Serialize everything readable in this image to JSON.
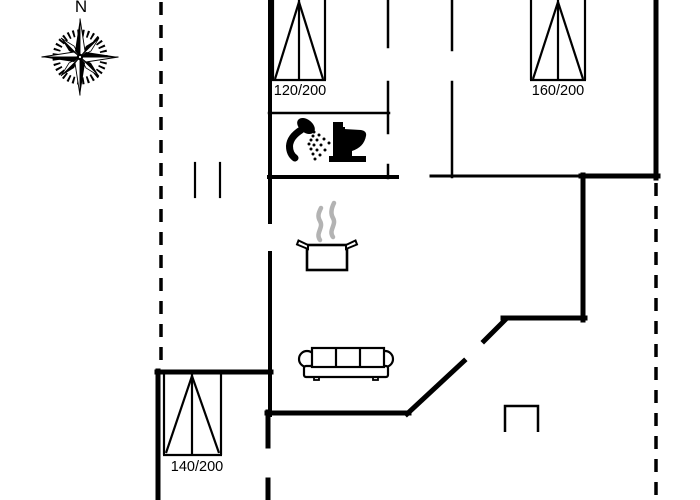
{
  "compass": {
    "north_label": "N"
  },
  "beds": [
    {
      "label": "120/200",
      "position": "top-left-bedroom"
    },
    {
      "label": "160/200",
      "position": "top-right-bedroom"
    },
    {
      "label": "140/200",
      "position": "bottom-left-bedroom"
    }
  ],
  "icons": {
    "compass": "compass-rose-icon",
    "bed": "double-bed-icon",
    "shower": "shower-head-icon",
    "toilet": "toilet-icon",
    "pot": "cooking-pot-icon",
    "steam": "steam-icon",
    "sofa": "sofa-icon",
    "niche": "niche-icon"
  },
  "colors": {
    "walls": "#000000",
    "steam": "#b3b3b3",
    "background": "#ffffff"
  }
}
